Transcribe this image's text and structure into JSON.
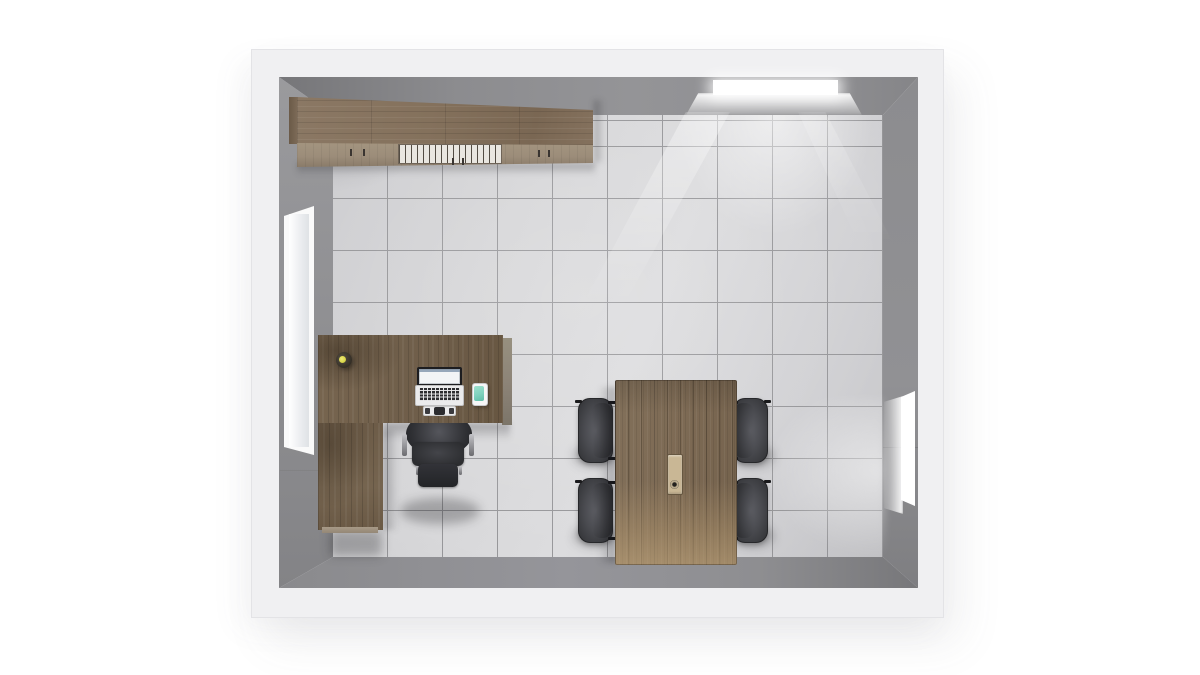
{
  "scene": {
    "label": "3D top-down render of a small office room",
    "room": {
      "label": "office room, bird's-eye view",
      "walls": {
        "label": "white walls with gray inner faces"
      },
      "floor": {
        "label": "gray ceramic tile floor",
        "tile_width_px": 55,
        "tile_height_px": 52
      },
      "windows": [
        {
          "label": "window in left wall"
        },
        {
          "label": "daylight window in top wall"
        },
        {
          "label": "daylight window in right wall"
        }
      ]
    },
    "furniture": [
      {
        "label": "walnut wall cabinet with doors and open slatted shelf"
      },
      {
        "label": "L-shaped walnut office desk with return pedestal"
      },
      {
        "label": "black mesh task chair at desk"
      },
      {
        "label": "open laptop on desk"
      },
      {
        "label": "smartphone with teal screen on desk"
      },
      {
        "label": "small desk lamp"
      },
      {
        "label": "walnut meeting table"
      },
      {
        "label": "gray meeting chair, top left"
      },
      {
        "label": "gray meeting chair, bottom left"
      },
      {
        "label": "gray meeting chair, top right"
      },
      {
        "label": "gray meeting chair, bottom right"
      },
      {
        "label": "recessed tabletop tray with bottle"
      }
    ]
  },
  "colors": {
    "bg": "#ffffff",
    "band": "#f0f0f2",
    "band-edge": "#e3e3e6",
    "face": "#909093",
    "face-dark": "#7b7b7e",
    "face-light": "#a9a9ac",
    "floor-a": "#cdcdd0",
    "floor-b": "#dcdcde",
    "grout": "#97979a",
    "wood-cab-top": "#84715c",
    "wood-cab-front": "#9c8d7a",
    "wood-desk": "#6f5e4a",
    "wood-desk-dark": "#57493a",
    "desk-strip": "#8d8478",
    "wood-table": "#7d6a54",
    "wood-table-light": "#a5906f",
    "grille": "#e9e6e0",
    "chair-dark": "#2e2f32",
    "chair-mid": "#4a4b50",
    "chair-light": "#5d5e64",
    "metal": "#a8a8ac",
    "laptop-body": "#ebebec",
    "laptop-keys": "#2c2c2f",
    "screen-frame": "#1d1d20",
    "screen-content": "#f2f4f6",
    "phone-screen": "#7fd2be",
    "lamp-accent": "#d8d549",
    "tray": "#c9b795",
    "window-frame": "#fafafa",
    "daylight": "#ffffff"
  }
}
